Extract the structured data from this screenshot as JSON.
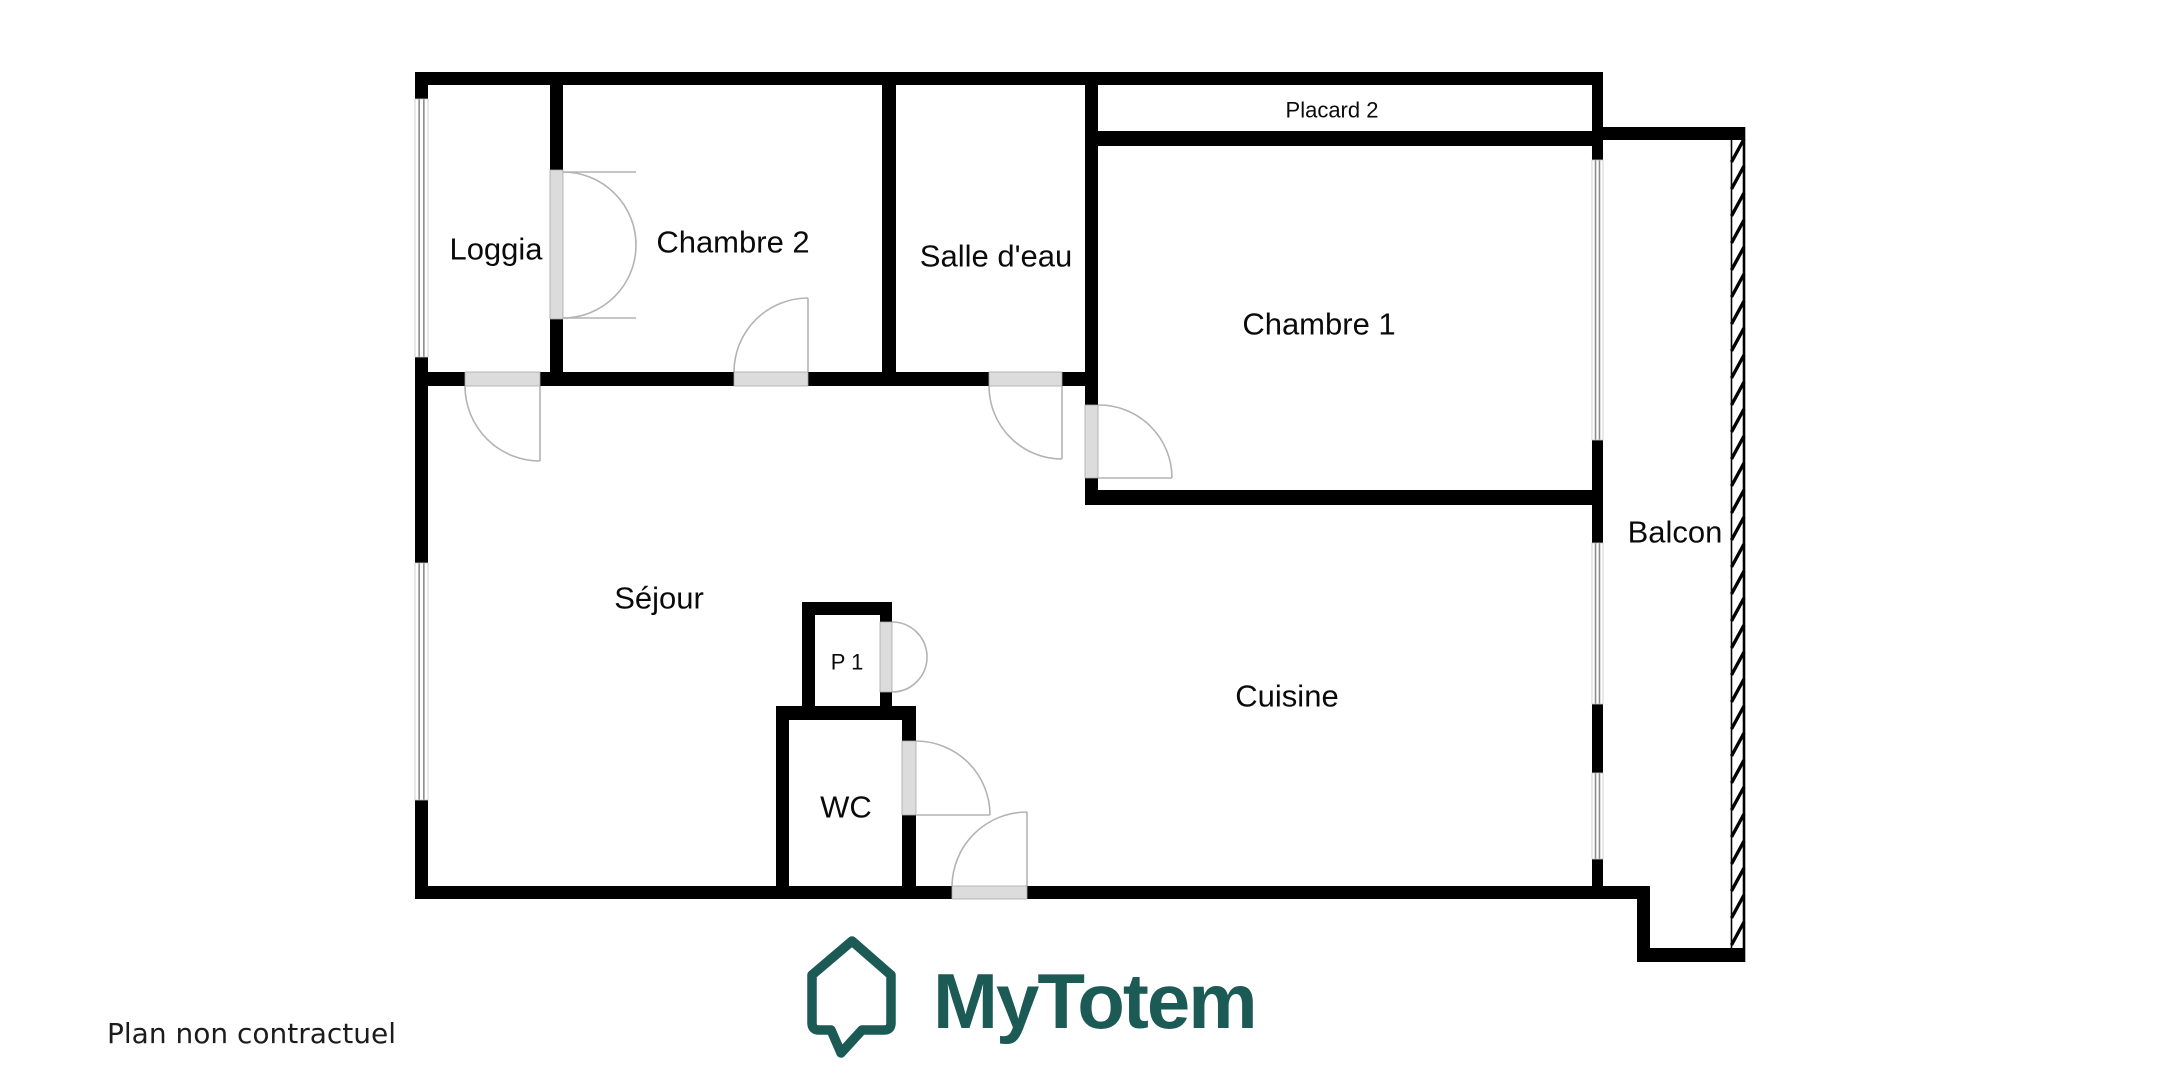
{
  "plan": {
    "labels": {
      "loggia": "Loggia",
      "chambre2": "Chambre 2",
      "salle_deau": "Salle d'eau",
      "placard2": "Placard 2",
      "chambre1": "Chambre 1",
      "balcon": "Balcon",
      "sejour": "Séjour",
      "p1": "P 1",
      "wc": "WC",
      "cuisine": "Cuisine"
    },
    "disclaimer": "Plan non contractuel"
  },
  "brand": {
    "name": "MyTotem",
    "color": "#1b5a55",
    "icon": "house-speech-bubble-icon"
  },
  "colors": {
    "walls": "#000000",
    "door_sill": "#dcdcdc",
    "door_arc": "#b3b3b3",
    "window_line": "#8c8c8c",
    "text": "#0a0a0a"
  }
}
